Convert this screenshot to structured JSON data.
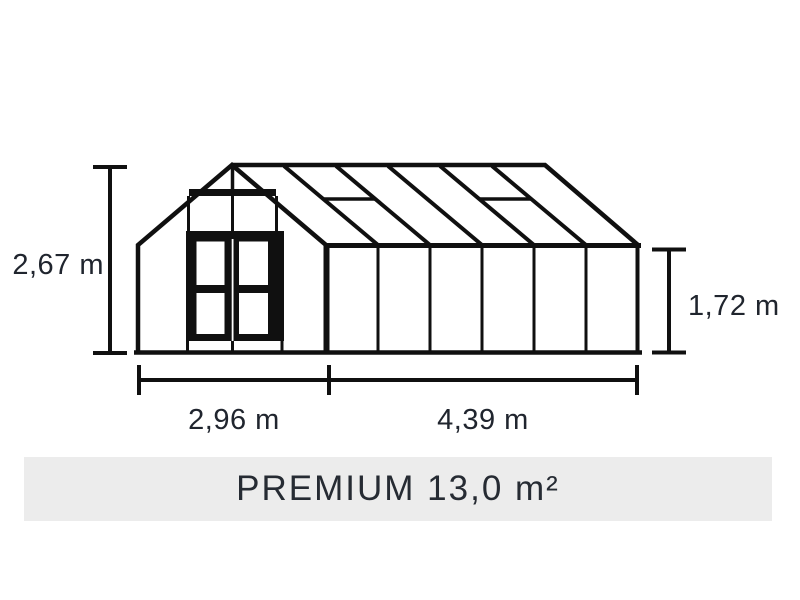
{
  "banner": {
    "title": "PREMIUM 13,0 m²"
  },
  "dimensions": {
    "front_height": "2,67 m",
    "side_height": "1,72 m",
    "front_width": "2,96 m",
    "side_length": "4,39 m"
  },
  "colors": {
    "line": "#101010",
    "label-text": "#20252e",
    "banner-bg": "#ececec",
    "banner-text": "#262b33",
    "page-bg": "#ffffff"
  }
}
